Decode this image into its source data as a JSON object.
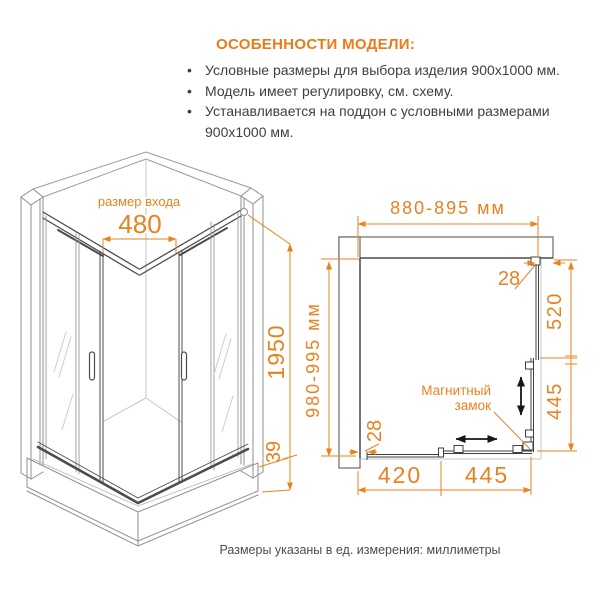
{
  "colors": {
    "accent": "#E8821F",
    "text": "#3f3f3f",
    "line_light": "#9c9c9c",
    "line_dark": "#4c4c4c"
  },
  "header": {
    "title": "ОСОБЕННОСТИ МОДЕЛИ:",
    "bullets": [
      "Условные размеры для выбора изделия 900x1000 мм.",
      "Модель имеет регулировку, см. схему.",
      "Устанавливается на поддон с условными размерами 900x1000 мм."
    ]
  },
  "iso": {
    "entrance_label": "размер входа",
    "entrance_size": "480",
    "height": "1950",
    "base_height": "39"
  },
  "plan": {
    "width": "880-895 мм",
    "depth": "980-995 мм",
    "top_gap": "28",
    "side_fixed": "520",
    "side_door": "445",
    "bottom_gap": "28",
    "bottom_fixed": "420",
    "bottom_door": "445",
    "lock_line1": "Магнитный",
    "lock_line2": "замок"
  },
  "footer": {
    "note": "Размеры указаны в ед. измерения: миллиметры"
  }
}
